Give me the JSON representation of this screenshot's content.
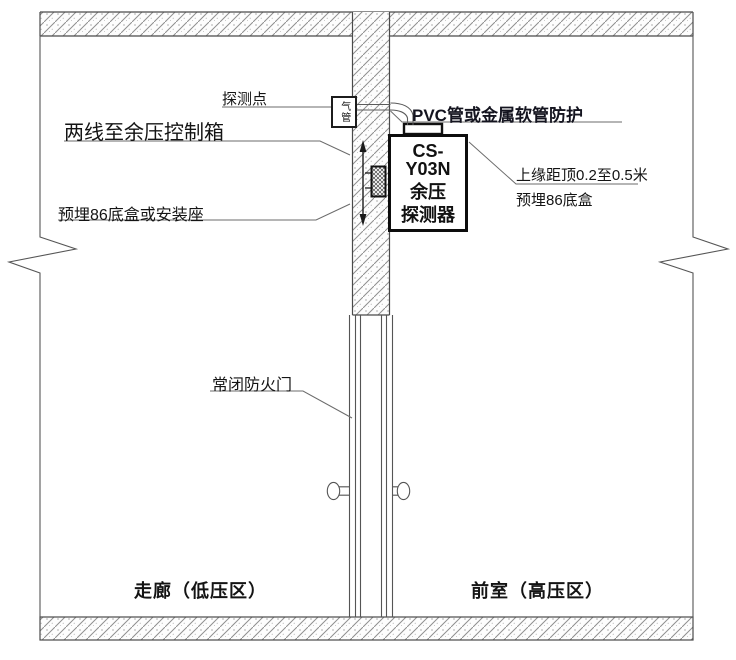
{
  "diagram": {
    "labels": {
      "detection_point": "探测点",
      "air_tube": "气管",
      "pvc_protection": "PVC管或金属软管防护",
      "wires_to_control_box": "两线至余压控制箱",
      "embedded_box_or_mount": "预埋86底盒或安装座",
      "top_edge_distance": "上缘距顶0.2至0.5米",
      "embedded_box": "预埋86底盒",
      "fire_door": "常闭防火门",
      "corridor": "走廊（低压区）",
      "anteroom": "前室（高压区）"
    },
    "detector": {
      "model": "CS-Y03N",
      "name_line1": "余压",
      "name_line2": "探测器"
    },
    "colors": {
      "background": "#ffffff",
      "line": "#4a4a4a",
      "leader": "#6b6b6b",
      "hatch": "#8f8f8f",
      "text": "#141414",
      "detector_border": "#0d0d0d"
    }
  }
}
